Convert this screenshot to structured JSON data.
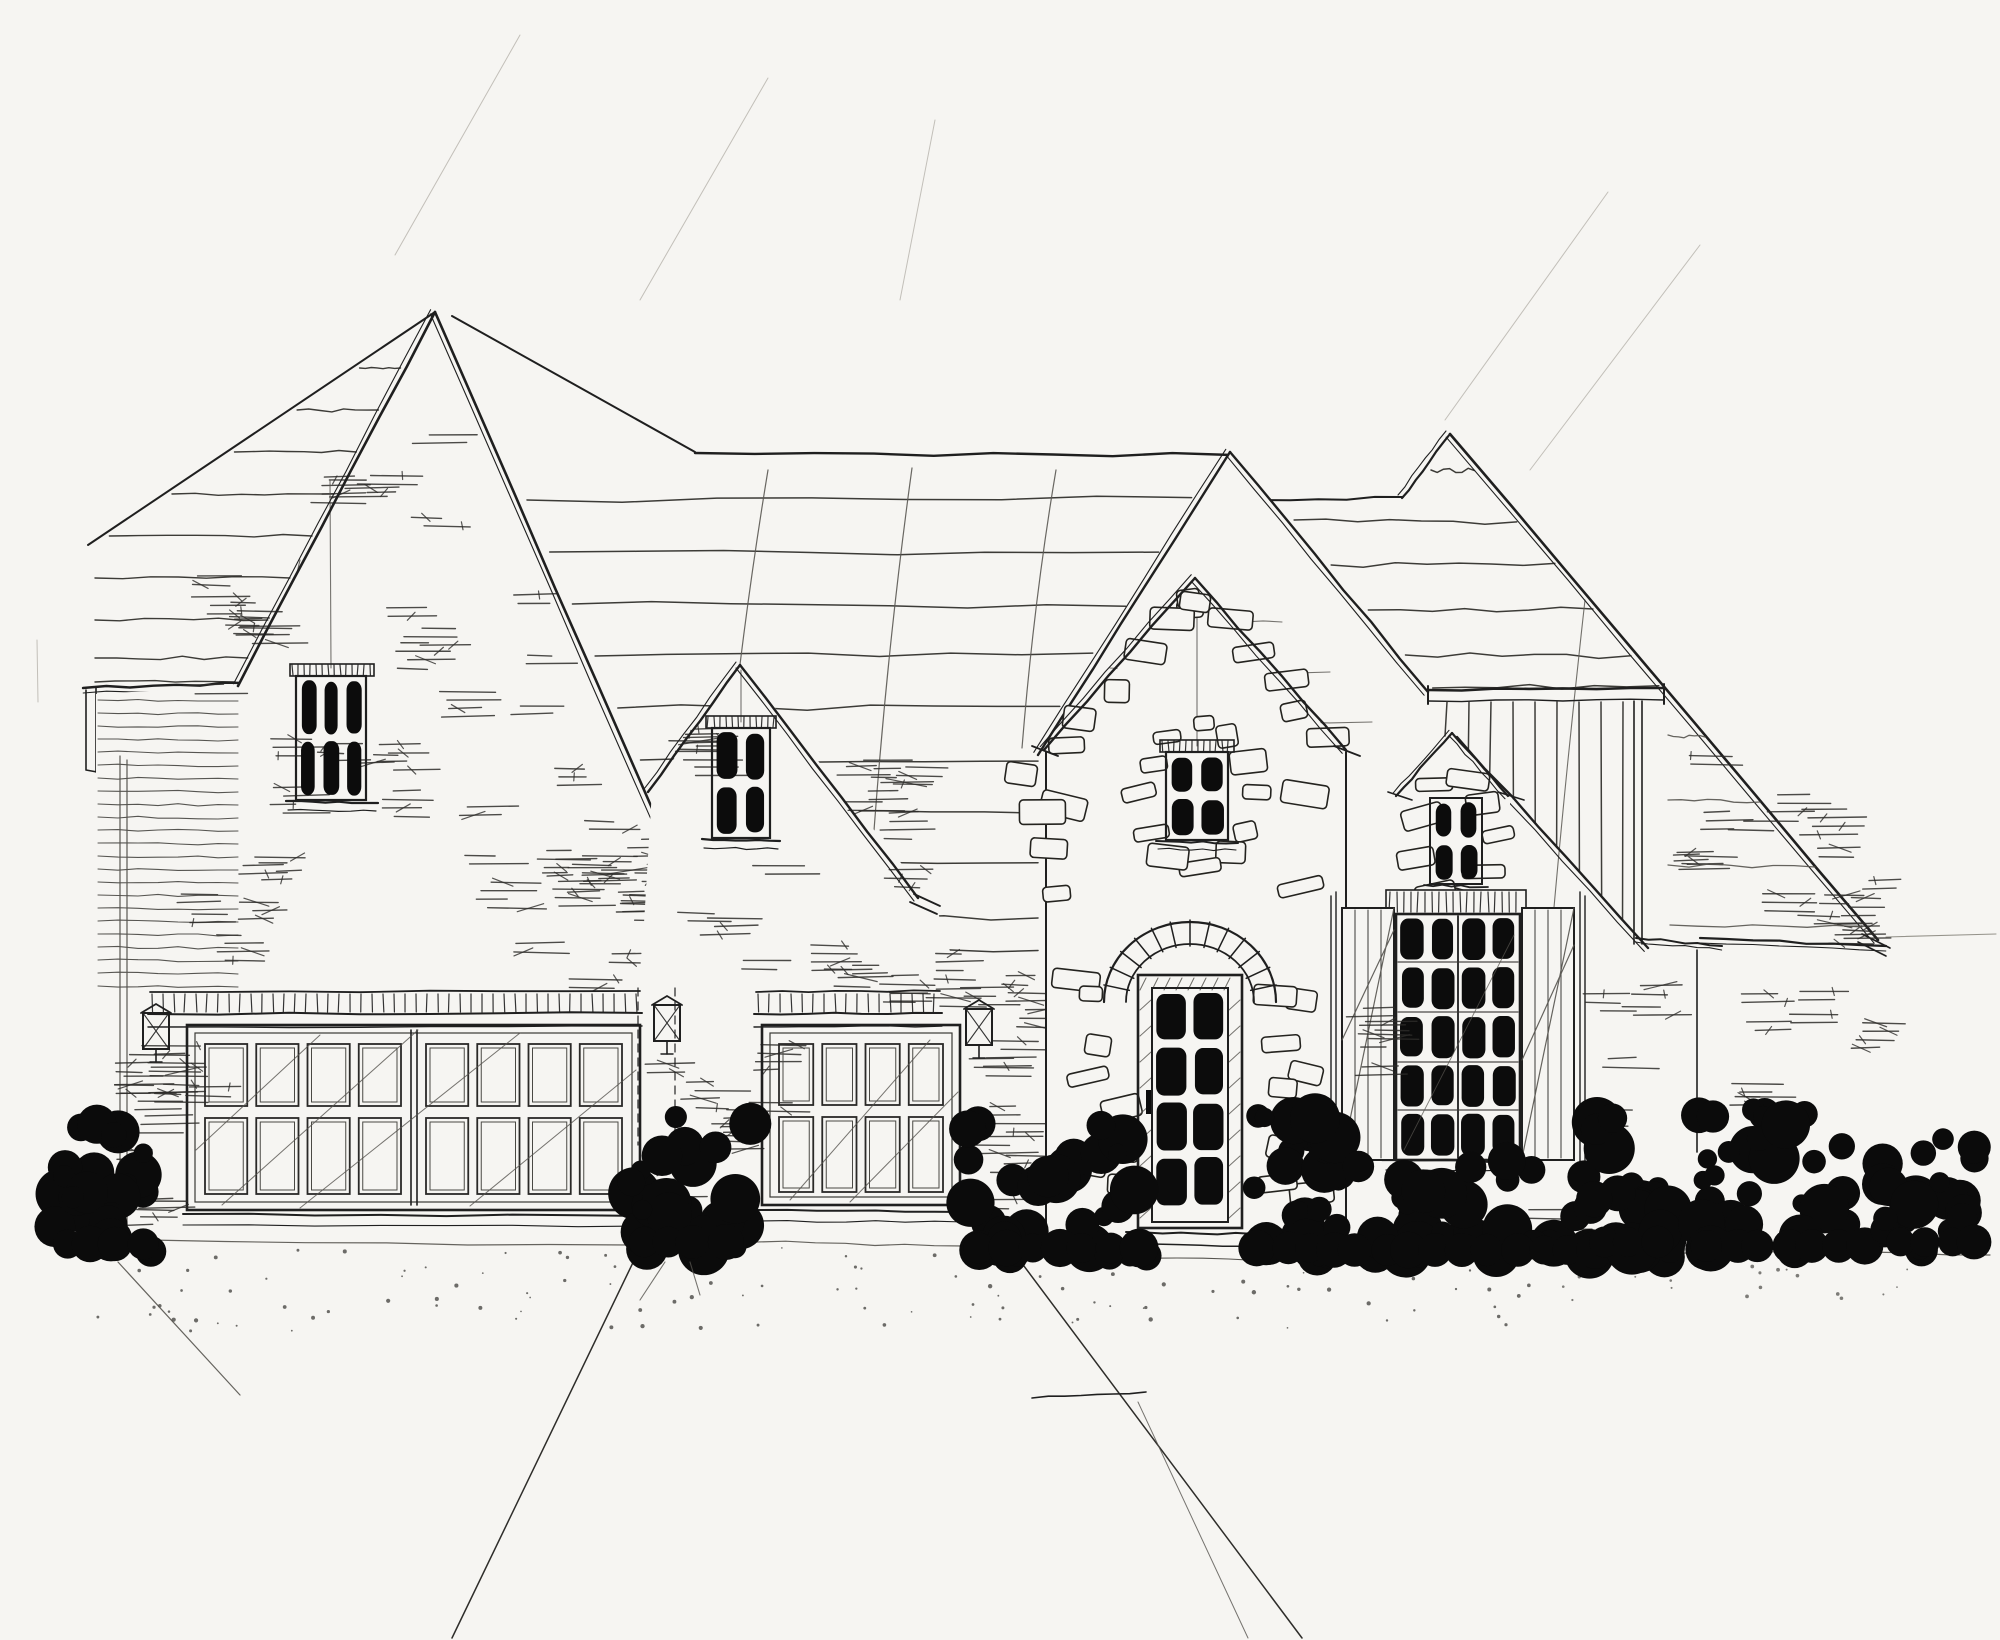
{
  "title": "Hand-drawn architectural front elevation sketch of a French country style house with stone entry tower, three-car garage and clipped shrubs",
  "medium": "pencil and ink line drawing on white paper, no text or labels visible",
  "palette": {
    "paper": "#f6f5f2",
    "ink": "#1f1f1f",
    "pencil": "#55534e",
    "light_pencil": "#8b8880",
    "construction": "#b5b2aa",
    "pane_dark": "#0c0c0c",
    "foliage": "#0b0b0b"
  },
  "scene": {
    "roof": {
      "style": "steep hand-sketched gable roofs with wavy shingle course lines",
      "gables": [
        "left front gable",
        "middle front gable",
        "center main gable",
        "stone entry tower gable",
        "bay window dormer",
        "right board-and-batten gable"
      ]
    },
    "windows": [
      {
        "id": "left-gable-window",
        "location": "left front gable",
        "panes_cols": 3,
        "panes_rows": 2
      },
      {
        "id": "middle-gable-window",
        "location": "middle front gable",
        "panes_cols": 2,
        "panes_rows": 2
      },
      {
        "id": "tower-window",
        "location": "entry tower above front door",
        "panes_cols": 2,
        "panes_rows": 2
      },
      {
        "id": "dormer-window",
        "location": "small dormer over bay window",
        "panes_cols": 2,
        "panes_rows": 2
      },
      {
        "id": "bay-window",
        "location": "right of entry, flanked by shutters",
        "panes_cols": 4,
        "panes_rows": 5
      }
    ],
    "doors": [
      {
        "id": "double-garage-door",
        "leaves": 2,
        "panel_cols": 4,
        "panel_rows": 2
      },
      {
        "id": "single-garage-door",
        "leaves": 1,
        "panel_cols": 4,
        "panel_rows": 2
      },
      {
        "id": "front-door",
        "location": "recessed in stone arch",
        "panes_cols": 2,
        "panes_rows": 4
      }
    ],
    "features": [
      "dentil trim bands above garage doors",
      "three wall lanterns",
      "irregular stone veneer on entry tower and dormer",
      "board and batten siding under right gable beam",
      "diagonal plank shutters on bay window",
      "solid black clipped shrubs along the foundation",
      "driveway and front walk lines with stipple dots"
    ]
  }
}
